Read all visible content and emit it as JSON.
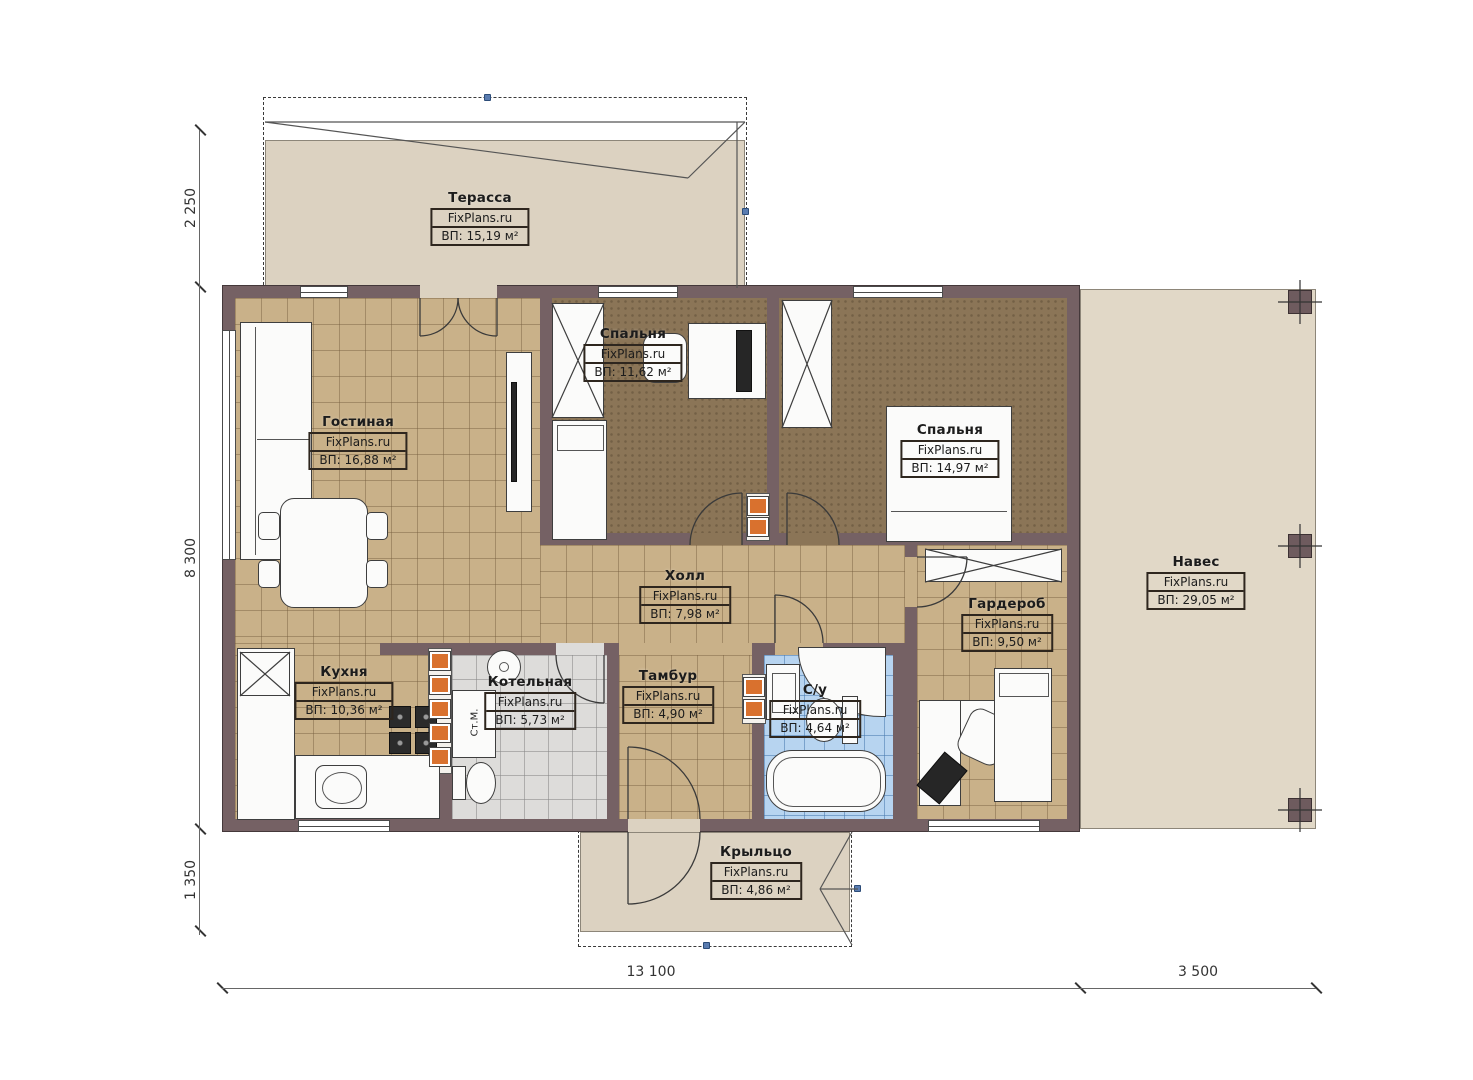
{
  "brand": "FixPlans.ru",
  "rooms": [
    {
      "key": "terrace",
      "name": "Терасса",
      "area": "ВП: 15,19 м²"
    },
    {
      "key": "living",
      "name": "Гостиная",
      "area": "ВП: 16,88 м²"
    },
    {
      "key": "bedroom1",
      "name": "Спальня",
      "area": "ВП: 11,62 м²"
    },
    {
      "key": "bedroom2",
      "name": "Спальня",
      "area": "ВП: 14,97 м²"
    },
    {
      "key": "hall",
      "name": "Холл",
      "area": "ВП: 7,98 м²"
    },
    {
      "key": "wardrobe",
      "name": "Гардероб",
      "area": "ВП: 9,50 м²"
    },
    {
      "key": "canopy",
      "name": "Навес",
      "area": "ВП: 29,05 м²"
    },
    {
      "key": "kitchen",
      "name": "Кухня",
      "area": "ВП: 10,36 м²"
    },
    {
      "key": "boiler",
      "name": "Котельная",
      "area": "ВП: 5,73 м²"
    },
    {
      "key": "tambour",
      "name": "Тамбур",
      "area": "ВП: 4,90 м²"
    },
    {
      "key": "bathroom",
      "name": "С/у",
      "area": "ВП: 4,64 м²"
    },
    {
      "key": "porch",
      "name": "Крыльцо",
      "area": "ВП: 4,86 м²"
    }
  ],
  "dimensions": {
    "left": [
      "2 250",
      "8 300",
      "1 350"
    ],
    "bottom": [
      "13 100",
      "3 500"
    ]
  },
  "fixtures": {
    "washer_label": "Ст.М."
  },
  "colors": {
    "wall": "#756164",
    "floor_tile_tan": "#c9b189",
    "floor_carpet": "#8b7557",
    "floor_tile_gray": "#dddcda",
    "floor_tile_blue": "#b7d4f0",
    "outdoor": "#dcd2c1",
    "vent_accent": "#d9712e",
    "grip": "#5a7cb0"
  }
}
